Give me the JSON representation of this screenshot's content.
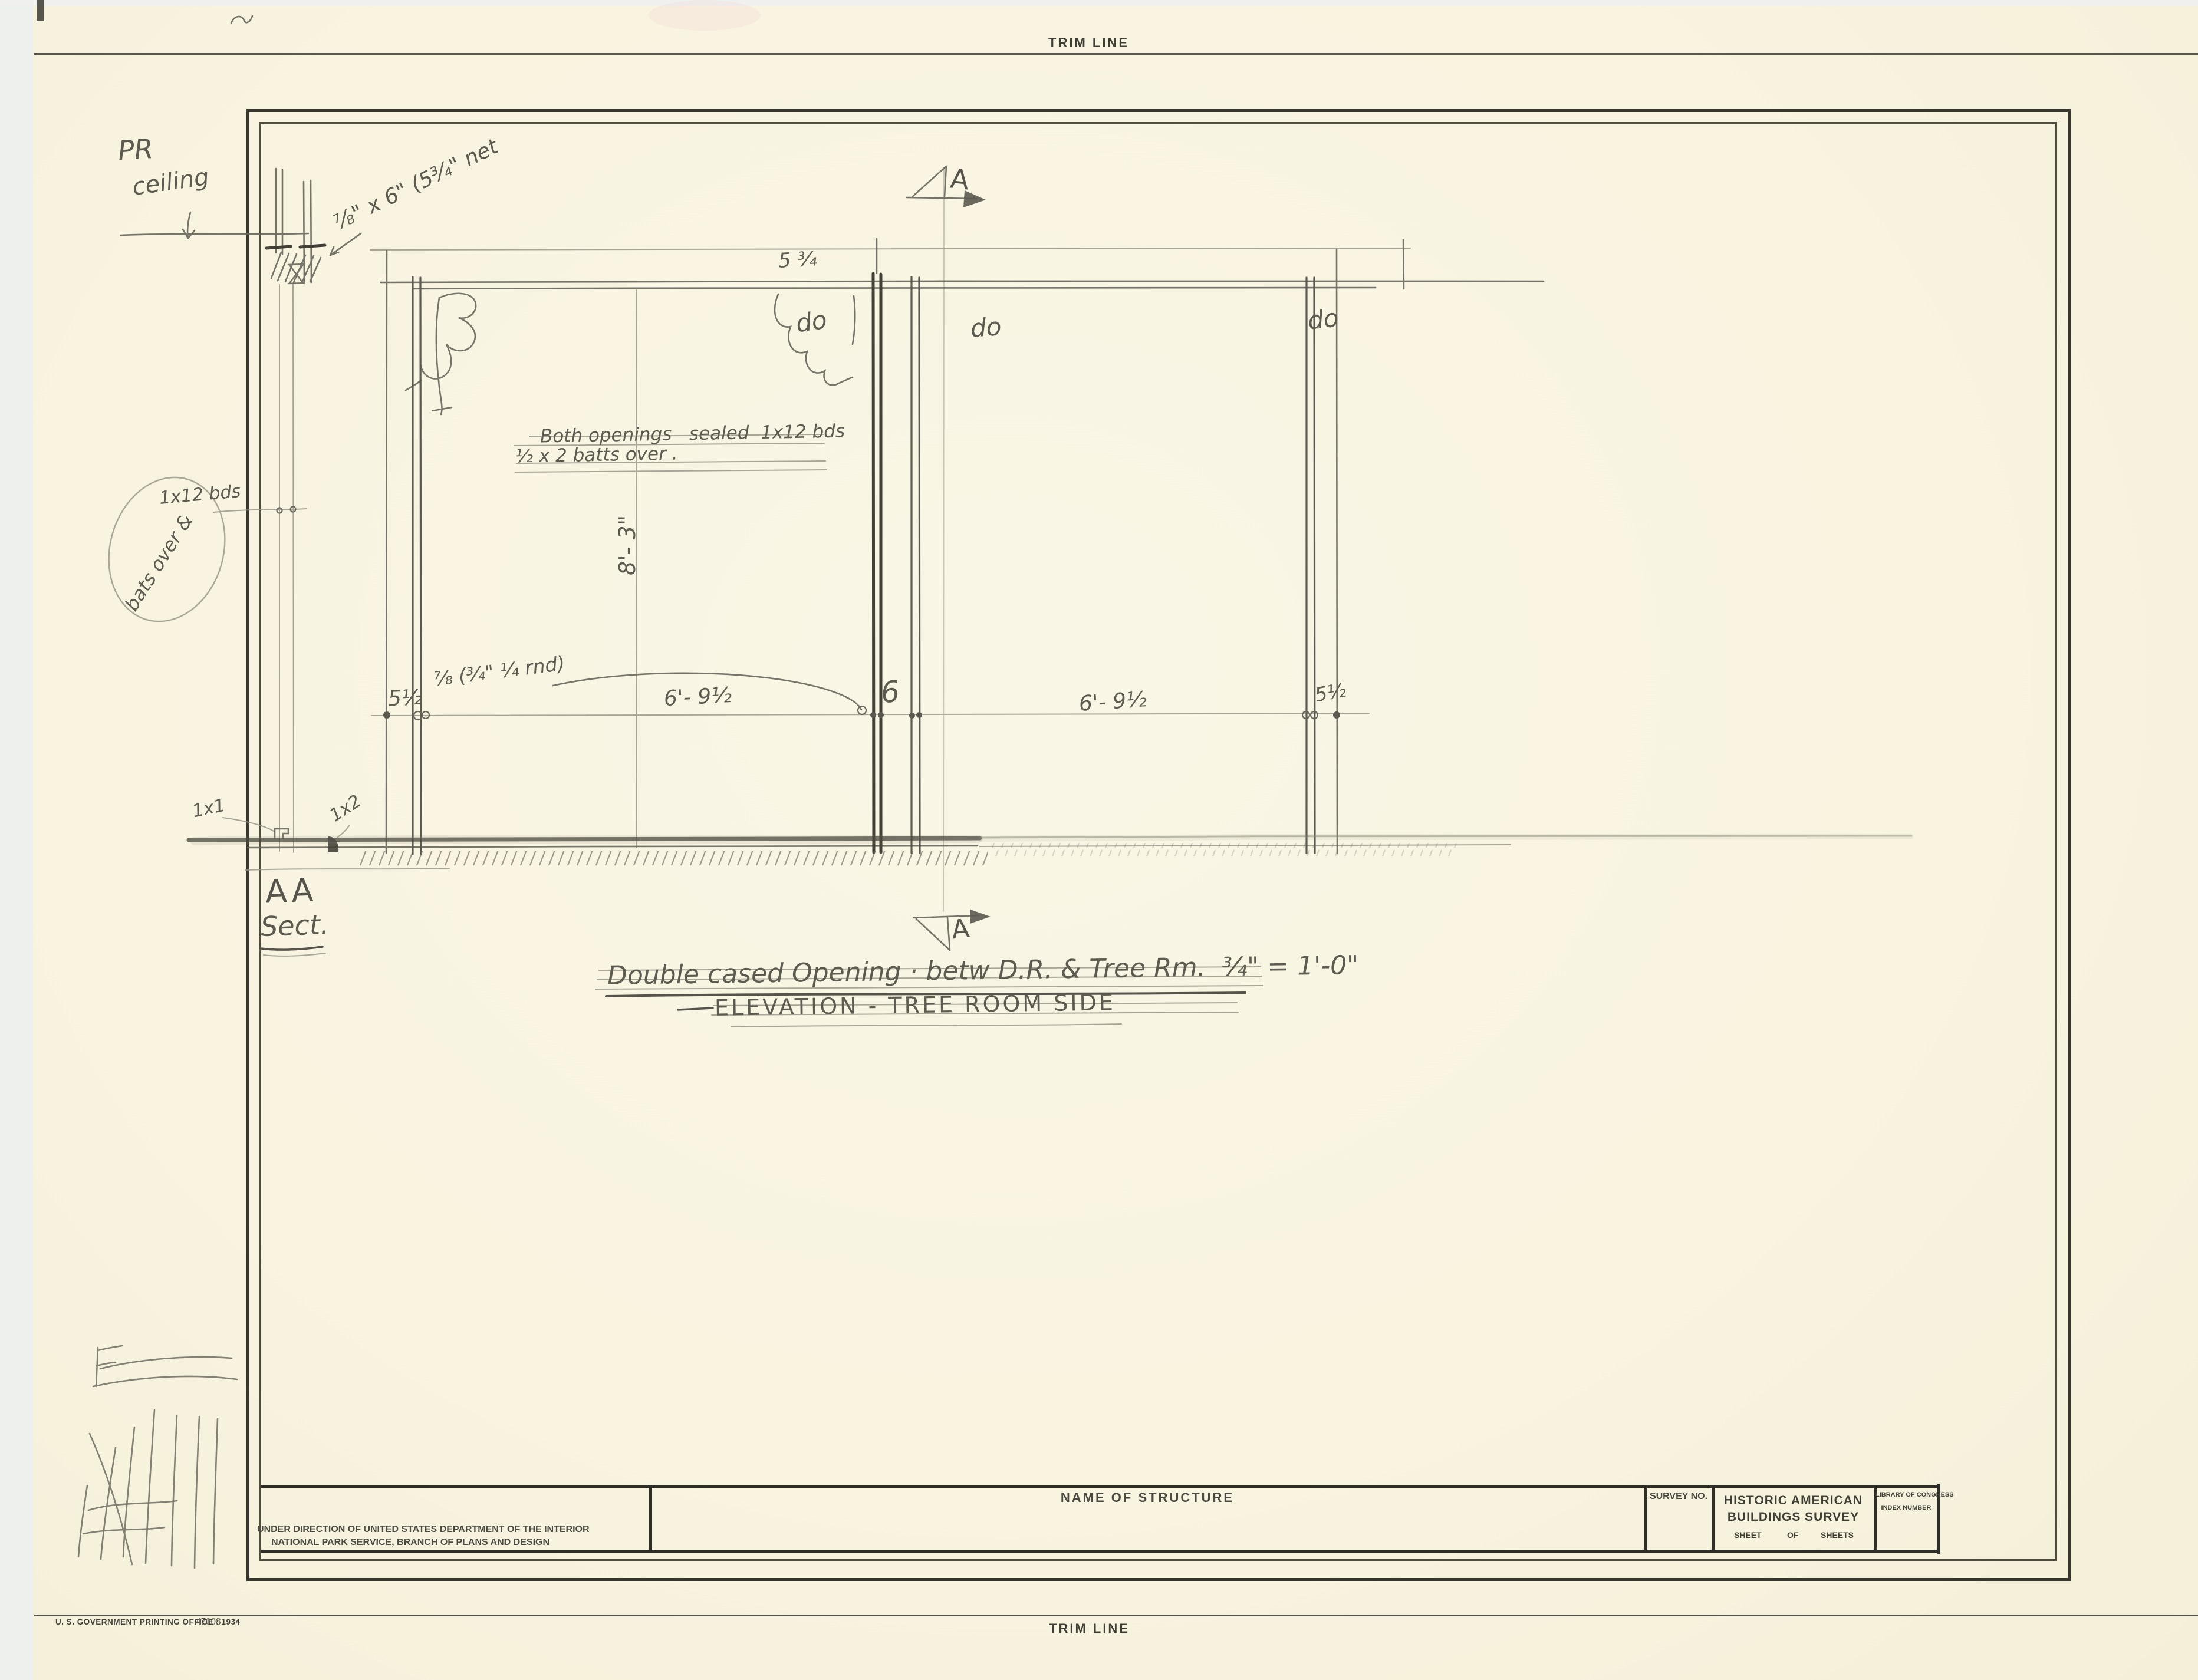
{
  "sheet": {
    "trim_top": "TRIM LINE",
    "trim_bottom": "TRIM LINE",
    "printer_credit": "U. S. GOVERNMENT PRINTING OFFICE : 1934",
    "printer_code": "47008"
  },
  "title_block": {
    "direction_line1": "UNDER DIRECTION OF UNITED STATES DEPARTMENT OF THE INTERIOR",
    "direction_line2": "NATIONAL PARK SERVICE, BRANCH OF PLANS AND DESIGN",
    "name_of_structure": "NAME OF STRUCTURE",
    "survey_no": "SURVEY NO.",
    "habs_line1": "HISTORIC AMERICAN",
    "habs_line2": "BUILDINGS SURVEY",
    "sheet": "SHEET",
    "of": "OF",
    "sheets": "SHEETS",
    "loc_line1": "LIBRARY OF CONGRESS",
    "loc_line2": "INDEX NUMBER"
  },
  "drawing": {
    "caption_line1": "Double cased Opening · betw D.R. & Tree Rm.  ¾\" = 1'-0\"",
    "caption_line2": "ELEVATION - TREE ROOM SIDE",
    "section_top_label": "A",
    "section_bottom_label": "A",
    "section_detail_label": "AA",
    "section_detail_word": "Sect.",
    "notes": {
      "pr": "PR",
      "ceiling": "ceiling",
      "head_size": "⅞\" x 6\" (5¾\" net",
      "openings_note_line1": "Both openings   sealed  1x12 bds",
      "openings_note_line2": "½ x 2 batts over .",
      "boards": "1x12 bds",
      "bats_over": "bats over &",
      "ditto1": "do",
      "ditto2": "do",
      "ditto3": "do",
      "one_by_one": "1x1",
      "one_by_two": "1x2"
    },
    "dimensions": {
      "head_width": "5 ¾",
      "left_casing": "5½",
      "round_note": "⅞ (¾\" ¼ rnd)",
      "left_opening": "6'- 9½",
      "mullion": "6",
      "right_opening": "6'- 9½",
      "right_casing": "5½",
      "height": "8'- 3\""
    }
  },
  "colors": {
    "paper": "#f9f5e1",
    "border_ink": "#38372d",
    "pencil": "#6b695e",
    "pencil_dark": "#413f36"
  }
}
